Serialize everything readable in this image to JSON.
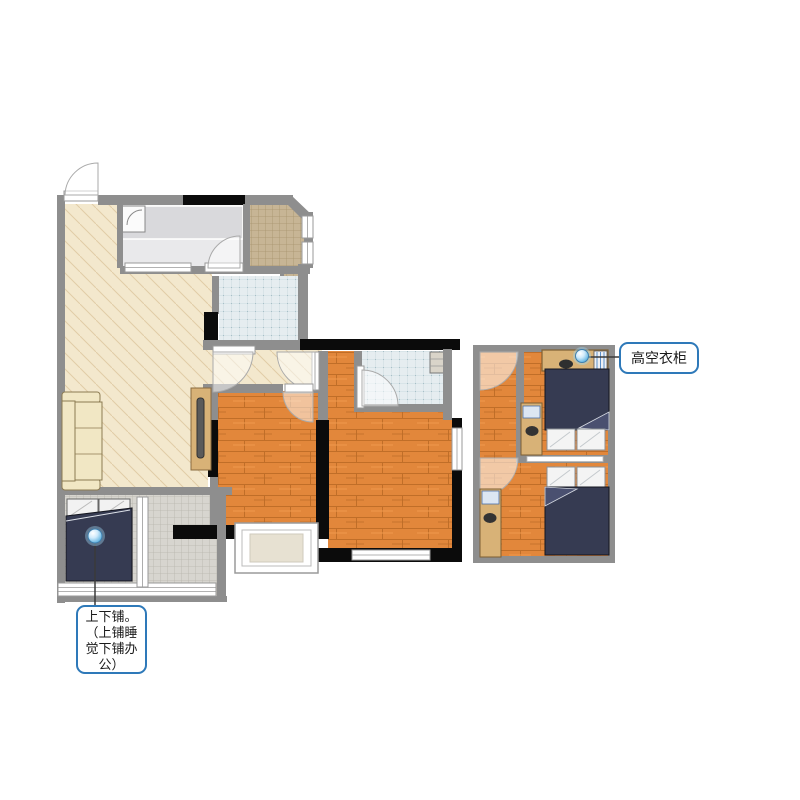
{
  "callouts": {
    "wardrobe": {
      "text": "高空衣柜"
    },
    "bunk": {
      "text": "上下铺。（上铺睡觉下铺办公）",
      "lines": [
        "上下铺。",
        "（上铺睡",
        "觉下铺办",
        "公）"
      ]
    }
  },
  "markers": {
    "count": 2,
    "style": "blue-sphere"
  },
  "colors": {
    "wall": "#8e8e8e",
    "structural_wall": "#0b0b0b",
    "living_floor": "#f3e8cd",
    "wood_floor": "#e2873b",
    "wood_line": "#c06e28",
    "bath_tile": "#e6edf0",
    "bath_grid": "#bfd2d8",
    "brown_tile": "#c7b595",
    "gray_tile": "#d7d5cf",
    "kitchen_floor": "#e9e9eb",
    "bed_blanket": "#363b52",
    "furniture_wood": "#d8b277",
    "sofa": "#f1e7c4",
    "label_border": "#2e79b9",
    "marker_blue": "#57aede",
    "callout_line": "#3a3a3a",
    "window_frame": "#9a9a9a"
  }
}
